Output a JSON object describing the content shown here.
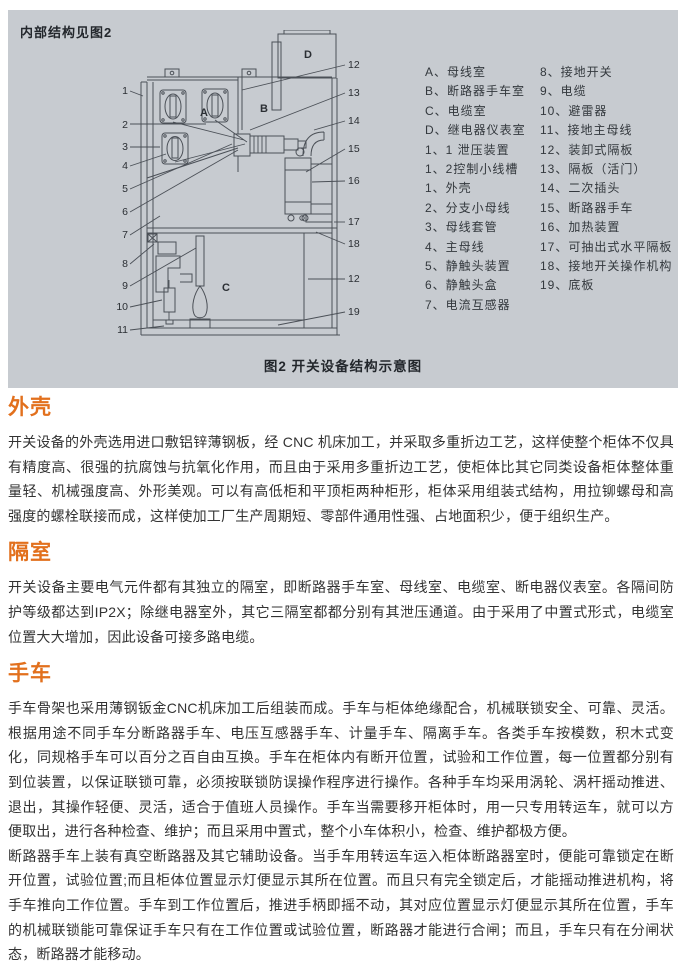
{
  "panel": {
    "title": "内部结构见图2",
    "caption": "图2 开关设备结构示意图",
    "diagram": {
      "rooms": {
        "a": "A",
        "b": "B",
        "c": "C",
        "d": "D"
      },
      "left_callouts": [
        "1",
        "2",
        "3",
        "4",
        "5",
        "6",
        "7",
        "8",
        "9",
        "10",
        "11"
      ],
      "right_callouts": [
        "12",
        "13",
        "14",
        "15",
        "16",
        "17",
        "18",
        "12",
        "19"
      ]
    },
    "legend": {
      "col1": [
        "A、母线室",
        "B、断路器手车室",
        "C、电缆室",
        "D、继电器仪表室",
        "1、1 泄压装置",
        "1、2控制小线槽",
        "1、外壳",
        "2、分支小母线",
        "3、母线套管",
        "4、主母线",
        "5、静触头装置",
        "6、静触头盒",
        "7、电流互感器"
      ],
      "col2": [
        "8、接地开关",
        "9、电缆",
        "10、避雷器",
        "11、接地主母线",
        "12、装卸式隔板",
        "13、隔板（活门）",
        "14、二次插头",
        "15、断路器手车",
        "16、加热装置",
        "17、可抽出式水平隔板",
        "18、接地开关操作机构",
        "19、底板"
      ]
    }
  },
  "sections": [
    {
      "heading": "外壳",
      "paragraphs": [
        "开关设备的外壳选用进口敷铝锌薄钢板，经 CNC 机床加工，并采取多重折边工艺，这样使整个柜体不仅具有精度高、很强的抗腐蚀与抗氧化作用，而且由于采用多重折边工艺，使柜体比其它同类设备柜体整体重量轻、机械强度高、外形美观。可以有高低柜和平顶柜两种柜形，柜体采用组装式结构，用拉铆螺母和高强度的螺栓联接而成，这样使加工厂生产周期短、零部件通用性强、占地面积少，便于组织生产。"
      ]
    },
    {
      "heading": "隔室",
      "paragraphs": [
        "开关设备主要电气元件都有其独立的隔室，即断路器手车室、母线室、电缆室、断电器仪表室。各隔间防护等级都达到IP2X；除继电器室外，其它三隔室都都分别有其泄压通道。由于采用了中置式形式，电缆室位置大大增加，因此设备可接多路电缆。"
      ]
    },
    {
      "heading": "手车",
      "paragraphs": [
        "手车骨架也采用薄钢钣金CNC机床加工后组装而成。手车与柜体绝缘配合，机械联锁安全、可靠、灵活。根据用途不同手车分断路器手车、电压互感器手车、计量手车、隔离手车。各类手车按模数，积木式变化，同规格手车可以百分之百自由互换。手车在柜体内有断开位置，试验和工作位置，每一位置都分别有到位装置，以保证联锁可靠，必须按联锁防误操作程序进行操作。各种手车均采用涡轮、涡杆摇动推进、退出，其操作轻便、灵活，适合于值班人员操作。手车当需要移开柜体时，用一只专用转运车，就可以方便取出，进行各种检查、维护；而且采用中置式，整个小车体积小，检查、维护都极方便。",
        "断路器手车上装有真空断路器及其它辅助设备。当手车用转运车运入柜体断路器室时，便能可靠锁定在断开位置，试验位置;而且柜体位置显示灯便显示其所在位置。而且只有完全锁定后，才能摇动推进机构，将手车推向工作位置。手车到工作位置后，推进手柄即摇不动，其对应位置显示灯便显示其所在位置，手车的机械联锁能可靠保证手车只有在工作位置或试验位置，断路器才能进行合闸；而且，手车只有在分闸状态，断路器才能移动。"
      ]
    }
  ],
  "colors": {
    "panel_bg": "#c7cbd0",
    "heading_orange": "#e2701d",
    "line": "#4b5057",
    "body_text": "#333333"
  }
}
